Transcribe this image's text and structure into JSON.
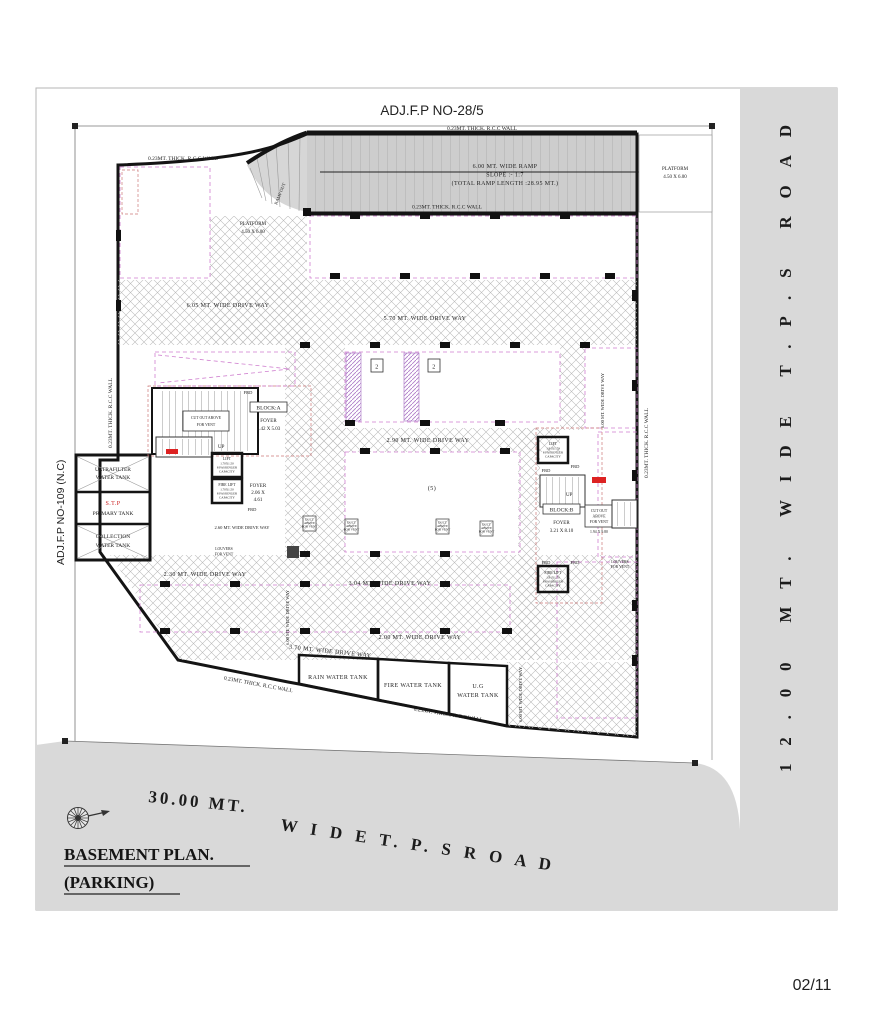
{
  "sheet": {
    "page_number": "02/11"
  },
  "title": {
    "line1": "BASEMENT PLAN.",
    "line2": "(PARKING)"
  },
  "borders": {
    "top_plot": "ADJ.F.P NO-28/5",
    "left_plot": "ADJ.F.P NO-109 (N.C)",
    "right_road": "12.00 MT.    WIDE    T.P.S    ROAD",
    "bottom_road_1": "30.00 MT.",
    "bottom_road_2": "W I D E    T. P. S     R O A D"
  },
  "walls": {
    "rcc": "0.23MT. THICK. R.C.C WALL"
  },
  "ramp": {
    "width": "6.00 MT. WIDE RAMP",
    "slope": "SLOPE :- 1:7",
    "length": "(TOTAL RAMP LENGTH :28.95 MT.)",
    "out": "RAMP OUT",
    "platform": "PLATFORM",
    "platform_dim": "4.50 X 6.00"
  },
  "driveways": {
    "main_left": "6.05 MT. WIDE DRIVE WAY",
    "main_right": "5.70 MT. WIDE DRIVE WAY",
    "center": "2.90 MT. WIDE DRIVE WAY",
    "lower_left": "2.30 MT. WIDE DRIVE WAY",
    "lower_center": "3.04 MT. WIDE DRIVE WAY",
    "bottom": "2.00 MT. WIDE DRIVE WAY",
    "bottom_left": "3.70 MT. WIDE DRIVE WAY",
    "inner_small": "2.60 MT. WIDE DRIVE WAY",
    "vertical": "6.00 MT. WIDE DRIVE WAY"
  },
  "tanks": {
    "ultrafilter_1": "ULTRAFILTER",
    "ultrafilter_2": "WATER TANK",
    "stp_1": "S.T.P",
    "stp_2": "PRIMARY TANK",
    "collection_1": "COLLECTION",
    "collection_2": "WATER TANK",
    "rain": "RAIN WATER TANK",
    "fire": "FIRE WATER TANK",
    "ug_1": "U.G",
    "ug_2": "WATER TANK"
  },
  "block_a": {
    "name": "BLOCK:A",
    "foyer": "FOYER",
    "dim": "3.42 X 5.03",
    "foyer2": "FOYER",
    "dim2_1": "2.06 X",
    "dim2_2": "4.61",
    "cut_1": "CUT OUT ABOVE",
    "cut_2": "FOR VENT"
  },
  "block_b": {
    "name": "BLOCK:B",
    "foyer": "FOYER",
    "dim": "3.21 X 8.10",
    "cut_1": "CUT OUT",
    "cut_2": "ABOVE",
    "cut_3": "FOR VENT",
    "cut_dim": "1.94 X 9.80"
  },
  "lifts": {
    "lift": "LIFT",
    "fire_lift": "FIRE LIFT",
    "dim_a": "1.70X1.50",
    "dim_b": "1.91X1.70",
    "cap_1": "8 PASSENGER",
    "cap_2": "CAPACITY"
  },
  "vents": {
    "duct_1": "DUCT",
    "duct_2": "ABOVE",
    "duct_3": "FOR VENT",
    "louvers_1": "LOUVERS",
    "louvers_2": "FOR VENT"
  },
  "marks": {
    "up": "UP",
    "frd": "FRD",
    "stall_two": "2",
    "stall_five": "(5)"
  }
}
